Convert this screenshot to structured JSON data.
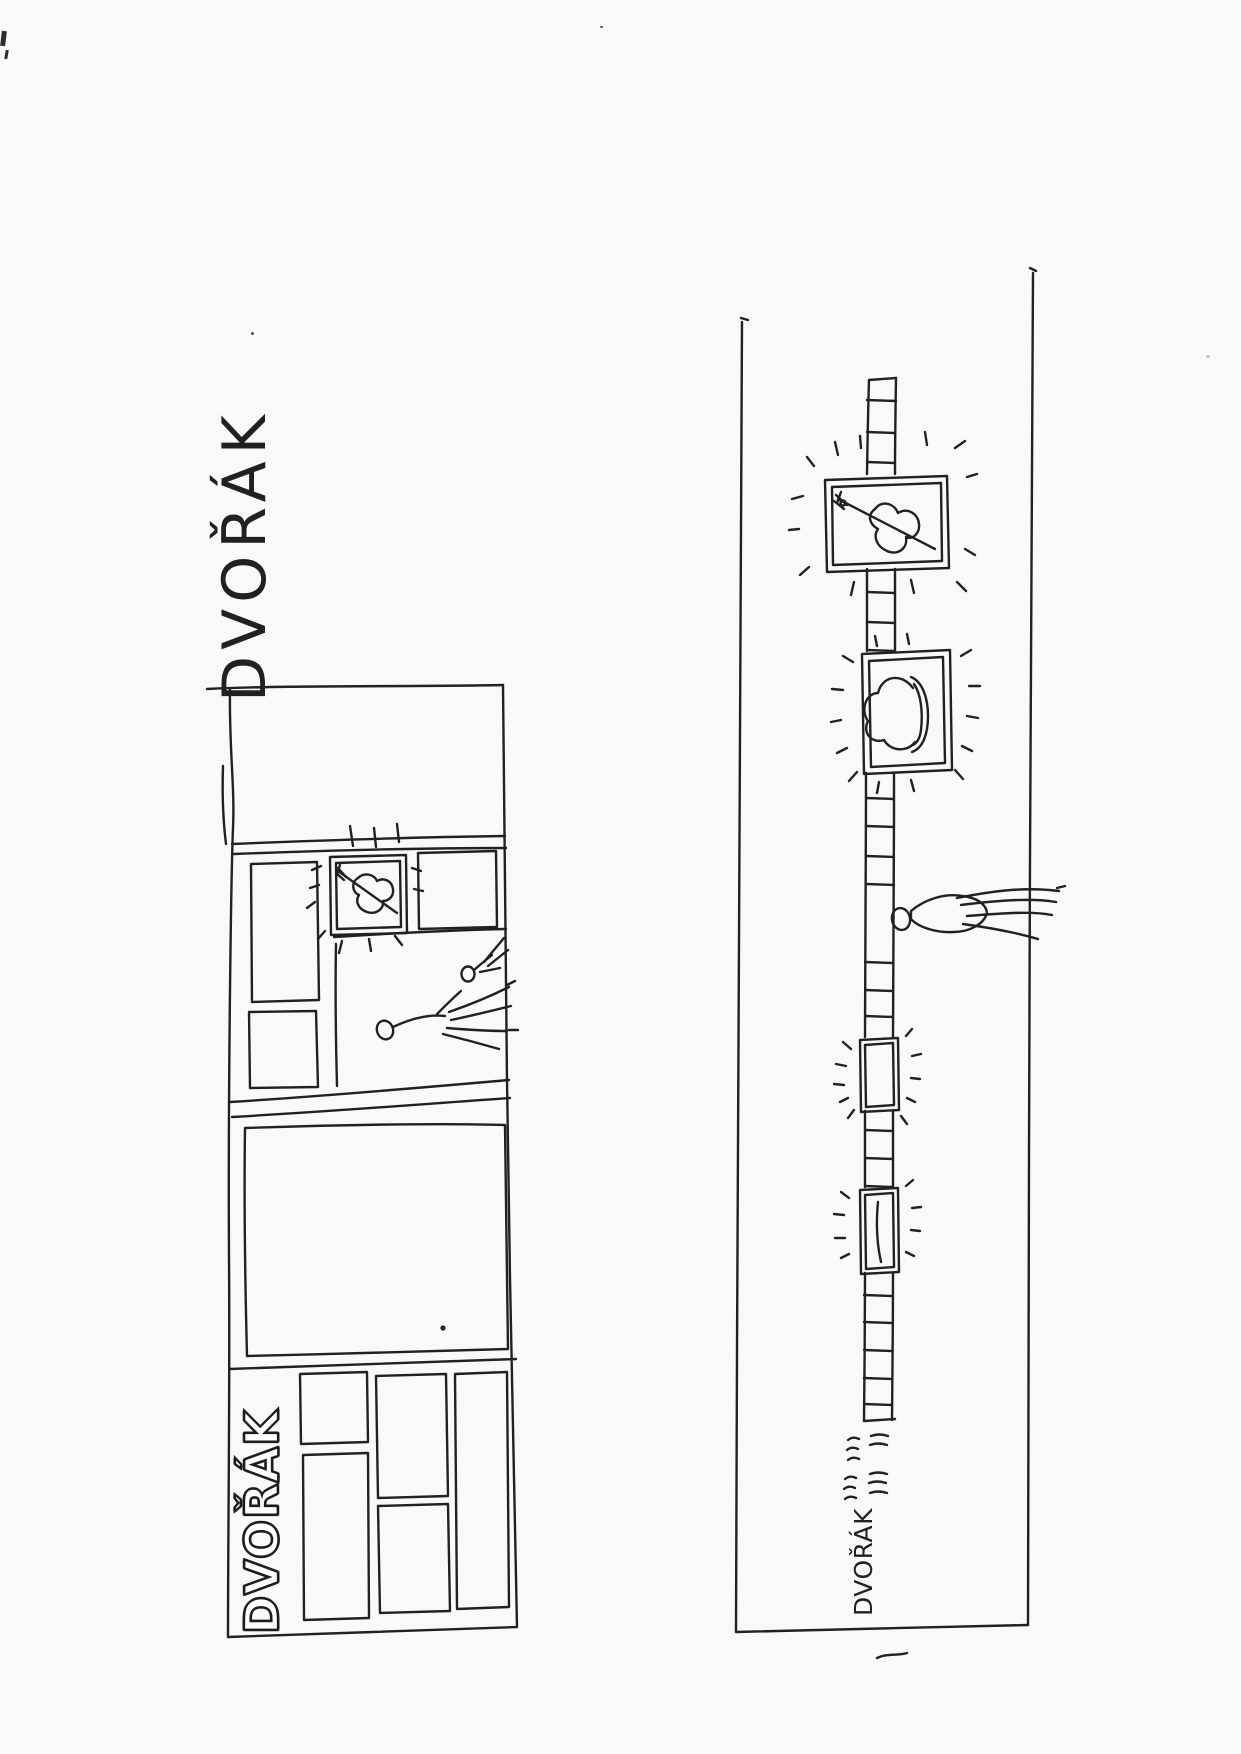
{
  "labels": {
    "main_title": "DVOŘÁK",
    "storefront_logo": "DVOŘÁK",
    "corridor_label": "DVOŘÁK"
  },
  "colors": {
    "paper": "#f9f9f7",
    "ink": "#222120",
    "pencil": "#c8c4be"
  },
  "panels": {
    "left": {
      "name": "exhibition-plan-sketch",
      "elements": [
        "panel-outline",
        "wall-bands",
        "small-rooms",
        "violin-frame",
        "violin-icon",
        "sparkle-dashes",
        "empty-frame",
        "visitor-figures",
        "large-room",
        "display-cases",
        "storefront-logo"
      ]
    },
    "right": {
      "name": "corridor-sketch",
      "elements": [
        "corridor-walls",
        "checkered-path",
        "violin-frame",
        "violin-icon",
        "hat-frame",
        "hat-icon",
        "visitor-figure",
        "small-frame-empty",
        "small-frame-baton",
        "approx-marks",
        "corridor-label",
        "sparkle-dashes"
      ]
    }
  }
}
